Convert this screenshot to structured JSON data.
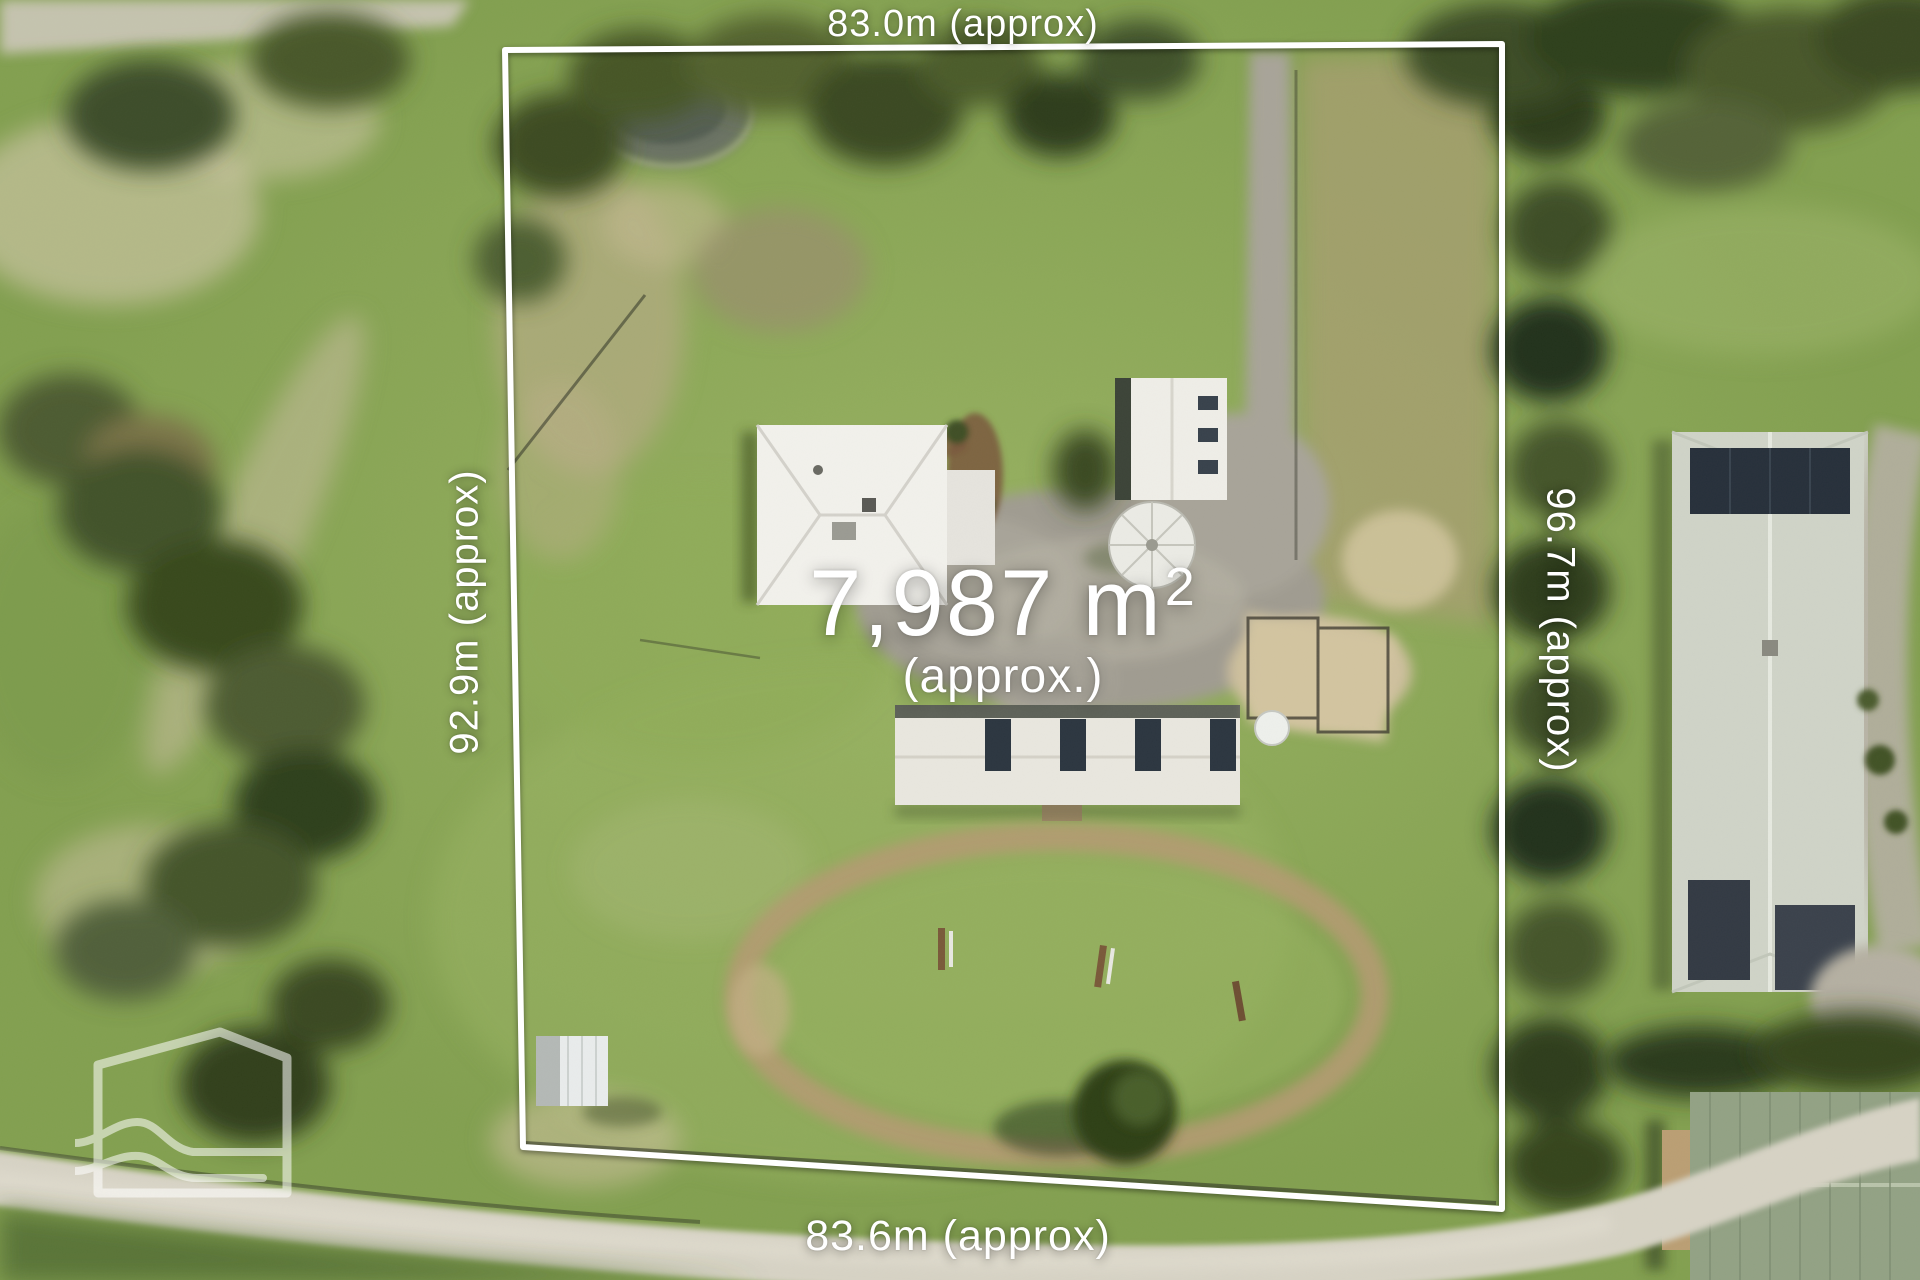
{
  "overlay": {
    "boundary_color": "#ffffff",
    "label_color": "#ffffff",
    "area": {
      "value": "7,987 m",
      "superscript": "2",
      "qualifier": "(approx.)"
    },
    "dimensions": {
      "top": "83.0m (approx)",
      "bottom": "83.6m (approx)",
      "left": "92.9m (approx)",
      "right": "96.7m (approx)"
    }
  },
  "watermark": {
    "icon": "house-with-hills-and-water-logo"
  }
}
